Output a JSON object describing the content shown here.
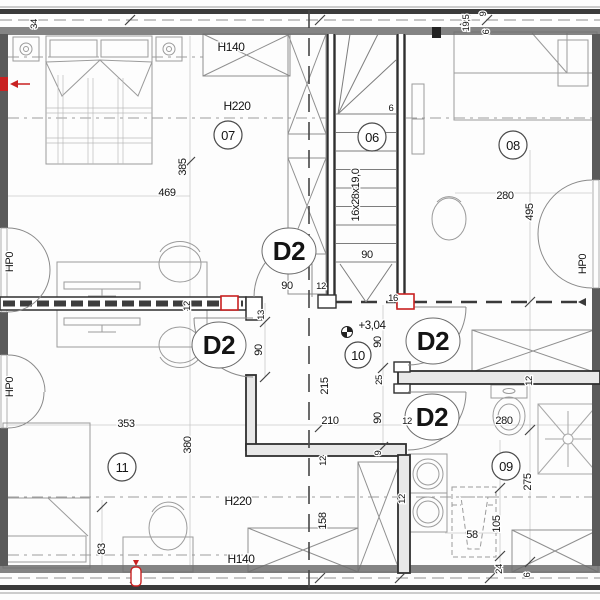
{
  "title": "attic floor plan",
  "colors": {
    "line": "#3a3a3a",
    "wall_dark": "#2f2f2f",
    "furniture": "#9b9b9b",
    "guide": "#c4c4c4",
    "accent_red": "#c92121"
  },
  "room_tags": [
    "07",
    "06",
    "08",
    "10",
    "11",
    "09"
  ],
  "door_tags": [
    "D2",
    "D2",
    "D2",
    "D2"
  ],
  "labels": {
    "d34": "34",
    "h140_top": "H140",
    "h220_top": "H220",
    "d385": "385",
    "d469": "469",
    "hp0_left_top": "HP0",
    "hp0_left_bottom": "HP0",
    "hp0_right": "HP0",
    "d19_5": "19,5",
    "d9_top": "9",
    "d6_top": "6",
    "stair_count": "6",
    "stair_formula": "16x28x19,0",
    "d90_stairs": "90",
    "d16": "16",
    "d12_door07": "12",
    "d280_top": "280",
    "d495": "495",
    "d12_midwall": "12",
    "d90_door07": "90",
    "d13": "13",
    "d90_door11": "90",
    "level": "+3,04",
    "d90_closet": "90",
    "d215": "215",
    "d25": "25",
    "d90_bathdoor": "90",
    "d210": "210",
    "d12_bathdoor": "12",
    "d9_nook": "9",
    "d12_nook": "12",
    "d12_closetwall": "12",
    "d12_bathwall": "12",
    "d280_bath": "280",
    "d275": "275",
    "d105": "105",
    "d58": "58",
    "d24": "24",
    "d6_bottom": "6",
    "d353": "353",
    "d380": "380",
    "d83": "83",
    "h220_bottom": "H220",
    "h140_bottom": "H140",
    "d158": "158"
  }
}
